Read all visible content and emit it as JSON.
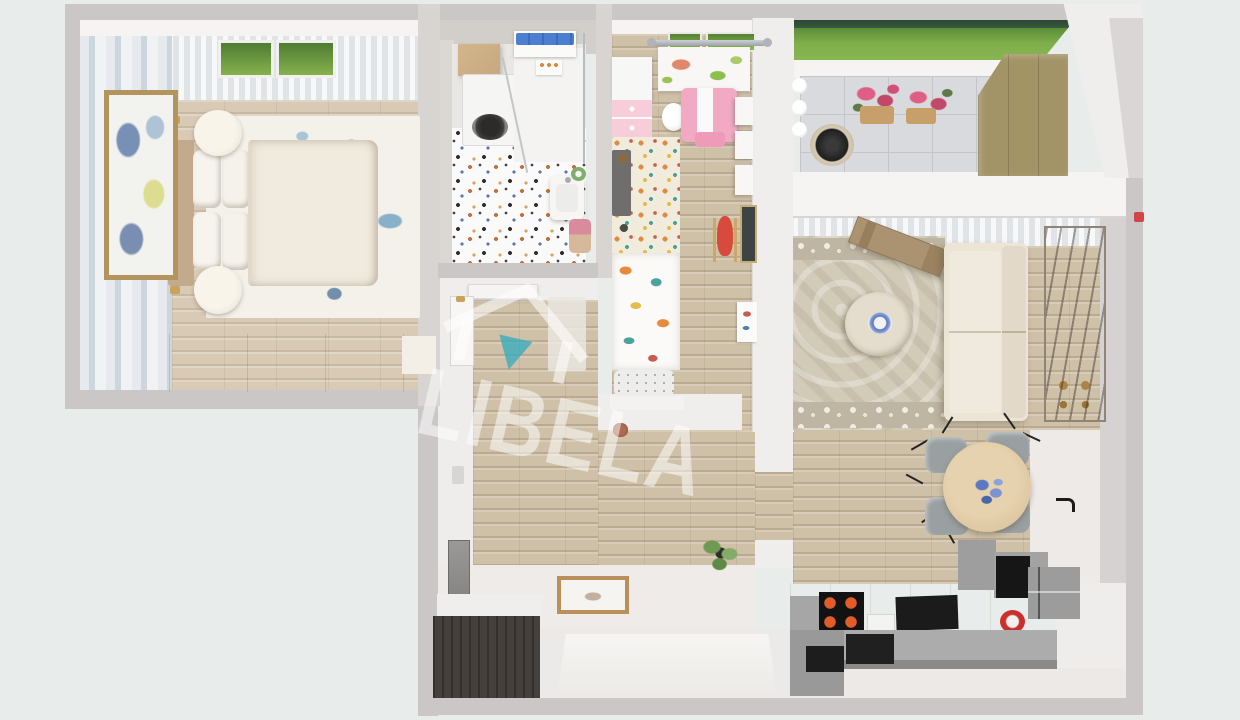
{
  "image_type": "3d-floorplan-top-down-render",
  "watermark": {
    "brand": "LIBELA",
    "icon": "house-with-down-arrow-icon",
    "accent_color": "#3aabbd",
    "text_color": "rgba(255,255,255,0.5)"
  },
  "rooms": [
    {
      "name": "bedroom",
      "position": "top-left",
      "furniture": [
        "double-bed",
        "tan-headboard",
        "pillows",
        "two-round-nightstands",
        "gold-wall-lamps",
        "blue-floral-rug",
        "framed-abstract-art",
        "cream-dresser",
        "white-curtains",
        "window-with-grass-view",
        "blue-watercolor-wallpaper"
      ]
    },
    {
      "name": "bathroom",
      "position": "top-center",
      "furniture": [
        "washing-machine",
        "wood-shelf",
        "blue-towels",
        "shower-with-glass",
        "sink",
        "switch-panel",
        "terrazzo-floor",
        "pink-basket",
        "green-wreath"
      ]
    },
    {
      "name": "kids-room",
      "position": "top-middle",
      "furniture": [
        "dinosaur-print-curtain",
        "curtain-rod",
        "pink-white-dresser",
        "pink-play-table",
        "white-stool",
        "pink-chair",
        "wall-shelves",
        "polka-dot-rug",
        "grey-play-mat",
        "animal-print-bed",
        "speckled-pillow",
        "red-rocking-horse",
        "chalkboard",
        "wall-poster"
      ]
    },
    {
      "name": "balcony",
      "position": "top-right",
      "furniture": [
        "grass-and-treeline-view",
        "grey-tile-floor",
        "two-pink-flower-pots",
        "round-grill",
        "white-buckets",
        "olive-wardrobe"
      ]
    },
    {
      "name": "living-room",
      "position": "right",
      "furniture": [
        "beige-sofa",
        "round-coffee-table",
        "blue-plate-ornament",
        "ornate-beige-rug",
        "winter-village-painting",
        "open-wood-door",
        "white-curtains",
        "door-handle",
        "red-wall-marker"
      ]
    },
    {
      "name": "dining-area",
      "position": "center-right",
      "furniture": [
        "round-wood-table",
        "blue-floral-centerpiece",
        "four-grey-chairs"
      ]
    },
    {
      "name": "kitchen",
      "position": "bottom-right",
      "furniture": [
        "l-shaped-counter",
        "black-cooktop-orange-burners",
        "black-oven",
        "grey-cabinets",
        "black-drawers",
        "red-pot",
        "white-appliance"
      ]
    },
    {
      "name": "hallway-entry",
      "position": "center",
      "furniture": [
        "wood-floor",
        "bedroom-door",
        "bathroom-door",
        "light-runner-mat",
        "wall-mirror",
        "espresso-shoe-cabinet",
        "framed-doormat",
        "entry-door-niche",
        "green-plant",
        "small-toy"
      ]
    }
  ],
  "colors": {
    "bg": "#e8edec",
    "wallGrey": "#cbc7c6",
    "wallGreyLight": "#d7d4d2",
    "wallWhite": "#f0eeec",
    "wallWhiteBright": "#f6f4f2",
    "wood": "#cfc0a8",
    "woodBed": "#d8cab5",
    "terrazzo": "#fbfafa",
    "polkaRug": "#f1ebdb",
    "tile": "#d9dadd",
    "grass": "#8ab653",
    "treeline": "#31503a",
    "rugBlueBase": "#f3f1ea",
    "rugOrnate": "#d2cbb8",
    "rugBorder": "#beb6a2",
    "headboardTan": "#c4aa8c",
    "bedCream": "#f1ebdf",
    "dresserCream": "#ebe4d3",
    "frameGold": "#b3945c",
    "towelBlue": "#4d7fd0",
    "shelfWood": "#c8a87e",
    "washerDoor": "#42403e",
    "pinkTable": "#f2a9c4",
    "pinkDresser": "#f6cdd9",
    "pinkChair": "#ef9ab8",
    "greyMat": "#6f6e6c",
    "dinoGreen": "#8cbf4e",
    "dinoSalmon": "#e08868",
    "horseRed": "#d84a3c",
    "chalkDark": "#3d4442",
    "flowerPink": "#df5e86",
    "potTan": "#c79f6a",
    "grillBlack": "#1f1f1f",
    "oliveWardrobe": "#a39468",
    "sofaCream": "#ece5d6",
    "coffeeTableCream": "#dbd4c3",
    "paintingDark": "#4b4338",
    "diningWood": "#dcc49e",
    "chairGrey": "#9aa0a1",
    "centerpieceBlue": "#5b79c0",
    "counterGrey": "#acacac",
    "counterCream": "#ece3d0",
    "applianceBlack": "#161616",
    "burnerOrange": "#e25c2a",
    "potRed": "#cb2f2b",
    "espresso": "#46403c",
    "entryFloor": "#eeebe9",
    "plantGreen": "#6e9a54",
    "watermarkTeal": "#3aabbd"
  }
}
